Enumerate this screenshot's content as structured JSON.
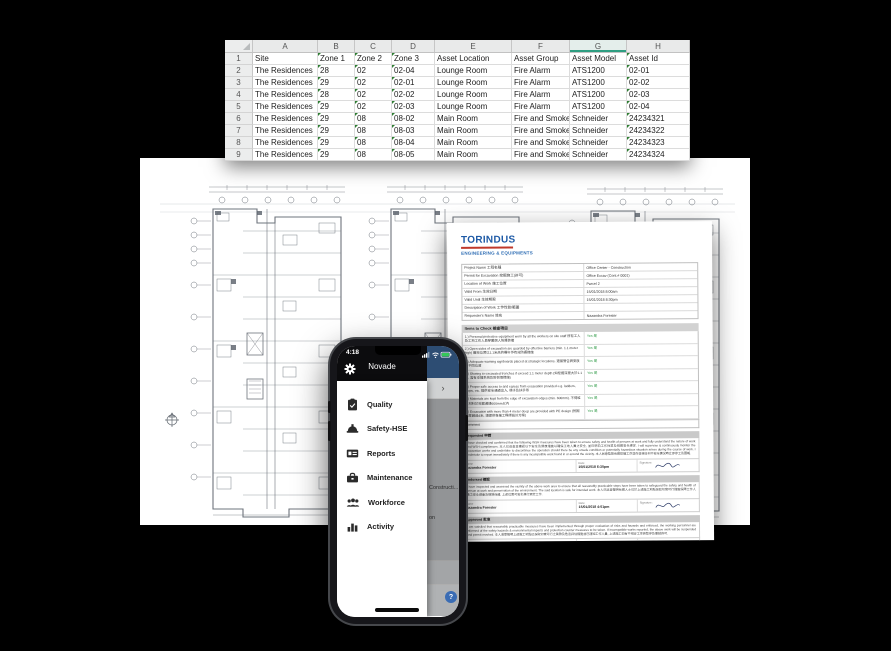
{
  "spreadsheet": {
    "column_letters": [
      "A",
      "B",
      "C",
      "D",
      "E",
      "F",
      "G",
      "H"
    ],
    "selected_column": "G",
    "accent_color": "#2f9e82",
    "rows": [
      [
        "Site",
        "Zone 1",
        "Zone 2",
        "Zone 3",
        "Asset Location",
        "Asset Group",
        "Asset Model",
        "Asset Id"
      ],
      [
        "The Residences",
        "28",
        "02",
        "02-04",
        "Lounge Room",
        "Fire Alarm",
        "ATS1200",
        "02-01"
      ],
      [
        "The Residences",
        "29",
        "02",
        "02-01",
        "Lounge Room",
        "Fire Alarm",
        "ATS1200",
        "02-02"
      ],
      [
        "The Residences",
        "28",
        "02",
        "02-02",
        "Lounge Room",
        "Fire Alarm",
        "ATS1200",
        "02-03"
      ],
      [
        "The Residences",
        "29",
        "02",
        "02-03",
        "Lounge Room",
        "Fire Alarm",
        "ATS1200",
        "02-04"
      ],
      [
        "The Residences",
        "29",
        "08",
        "08-02",
        "Main Room",
        "Fire and Smoke A",
        "Schneider",
        "24234321"
      ],
      [
        "The Residences",
        "29",
        "08",
        "08-03",
        "Main Room",
        "Fire and Smoke A",
        "Schneider",
        "24234322"
      ],
      [
        "The Residences",
        "29",
        "08",
        "08-04",
        "Main Room",
        "Fire and Smoke A",
        "Schneider",
        "24234323"
      ],
      [
        "The Residences",
        "29",
        "08",
        "08-05",
        "Main Room",
        "Fire and Smoke A",
        "Schneider",
        "24234324"
      ]
    ]
  },
  "phone": {
    "status": {
      "time": "4:18"
    },
    "app_bar": {
      "title": "Novade"
    },
    "menu": [
      {
        "icon": "clipboard-check-icon",
        "label": "Quality"
      },
      {
        "icon": "hardhat-icon",
        "label": "Safety-HSE"
      },
      {
        "icon": "id-card-icon",
        "label": "Reports"
      },
      {
        "icon": "toolbox-icon",
        "label": "Maintenance"
      },
      {
        "icon": "people-icon",
        "label": "Workforce"
      },
      {
        "icon": "bar-chart-icon",
        "label": "Activity"
      }
    ],
    "background": {
      "chevron": "›",
      "partial_line_1": "Constructi...",
      "partial_line_2": "on",
      "help_label": "?",
      "header_color": "#2d4d73",
      "fab_color": "#3a6cb4"
    }
  },
  "permit": {
    "logo_title": "TORINDUS",
    "logo_subtitle": "ENGINEERING & EQUIPMENTS",
    "brand_blue": "#1e5aa6",
    "brand_red": "#c0392b",
    "info_rows": [
      {
        "label": "Project Name 工程名稱",
        "value": "Office Center - Construction"
      },
      {
        "label": "Permit for Excavation 挖掘施工(許可)",
        "value": "Office Excav (Cont.# 0001)"
      },
      {
        "label": "Location of Work 施工位置",
        "value": "Parcel 2"
      },
      {
        "label": "Valid From 生效日期",
        "value": "15/01/2018 8:00am"
      },
      {
        "label": "Valid Until 生效期限",
        "value": "15/01/2018 8:30pm"
      },
      {
        "label": "Description of Work 工作性質/範圍",
        "value": ""
      },
      {
        "label": "Requester's Name 姓名",
        "value": "Nazandra Forester"
      }
    ],
    "items_header": "Items to Check 檢查項目",
    "checklist": [
      {
        "text": "1.) Personal protective equipment worn by all the workers on site staff 所有工人及工地工作人員穿戴個人防護裝備",
        "answer": "Yes 是"
      },
      {
        "text": "2.) Open sides of excavation are guarded by effective barriers (min. 1.1 meter high) 開挖位置以1.1米高的欄杆作有效防護措施",
        "answer": "Yes 是"
      },
      {
        "text": "3.) Adequate warning signboards placed at strategic locations. 適當警告牌安放於不同位置",
        "answer": "Yes 是"
      },
      {
        "text": "4.) Shoring to excavated trenches if exceed 1.1 meter depth (如挖掘深度大於1.1米, 需有支撐系統及防倒塌措施)",
        "answer": "Yes 是"
      },
      {
        "text": "5.) Proper safe access to and egress from excavation provided e.g. ladders, steps, etc. 提供安全通道出入, 梯子及扶手等",
        "answer": "Yes 是"
      },
      {
        "text": "6.) Materials are kept from the edge of excavation edges (min. 600mm). 不得堆放材料於挖掘邊緣600mm以內",
        "answer": "Yes 是"
      },
      {
        "text": "7.) Excavation with more than 4 meter deep are provided with PE design (挖掘深度超過4米, 須提供專業工程師設計方案)",
        "answer": "Yes 是"
      }
    ],
    "comment_label": "Comment",
    "labels": {
      "name": "Name",
      "date": "Date:",
      "signature": "Signature:"
    },
    "sections": [
      {
        "header": "Requested 申請",
        "body": "I have checked and confirmed that the following WSH measures have been taken to ensure safety and health of persons at work and fully understand the nature of work and WSH compliances. 本人已巡查並確認以下安全及健康措施以確保工地人員之安全, 並已明白工作性質及相關安全規定. I will supervise & continuously monitor the excavation works and undertake to discontinue the operation should there be any unsafe condition or potentially hazardous situation arises during the course of work. I undertake to report immediately if there is any incompatible work found in or around the vicinity. 本人同意監督有關挖掘工序並在發現任何不安全情況時立即停工及匯報.",
        "name": "Nazandra Forester",
        "date": "15/01/2018 6:30pm"
      },
      {
        "header": "Endorsed 確認",
        "body": "I have inspected and assessed the vicinity of the above work area to ensure that all reasonably practicable steps have been taken to safeguard the safety and health of person at work and preservation of the environment. The said location is safe for intended work. 本人已巡查聲明有關人士已於上述施工地點採取切實可行措施保障工作人員之安全健康及環境保護, 上述位置可安全進行預定工作.",
        "name": "Nazandra Forester",
        "date": "15/01/2018 4:01pm"
      },
      {
        "header": "Approved 批准",
        "body": "I am satisfied that reasonably practicable measures have been implemented through proper evaluation of risks and hazards and enforced, the working personnel are informed of the safety hazards & environmental impacts and protection counter measures to be taken. If incompatible works reported, the above work will be suspended and permit revoked. 本人滿意聲明上述施工地點已採取切實可行之風險及危害評估措施並已通知工作人員, 上述施工如有不相容工序將暫停及撤銷許可.",
        "name": "Ken Ng",
        "date": "15/01/2018 2:30pm"
      },
      {
        "header": "Completion 完工",
        "body": "Confirmed that the excavation operation is completed. 本人確認聲明上述施工地點的挖掘工序經已完成。",
        "name": "Ken Ng",
        "date": "15/01/2018 2:30pm"
      }
    ]
  }
}
